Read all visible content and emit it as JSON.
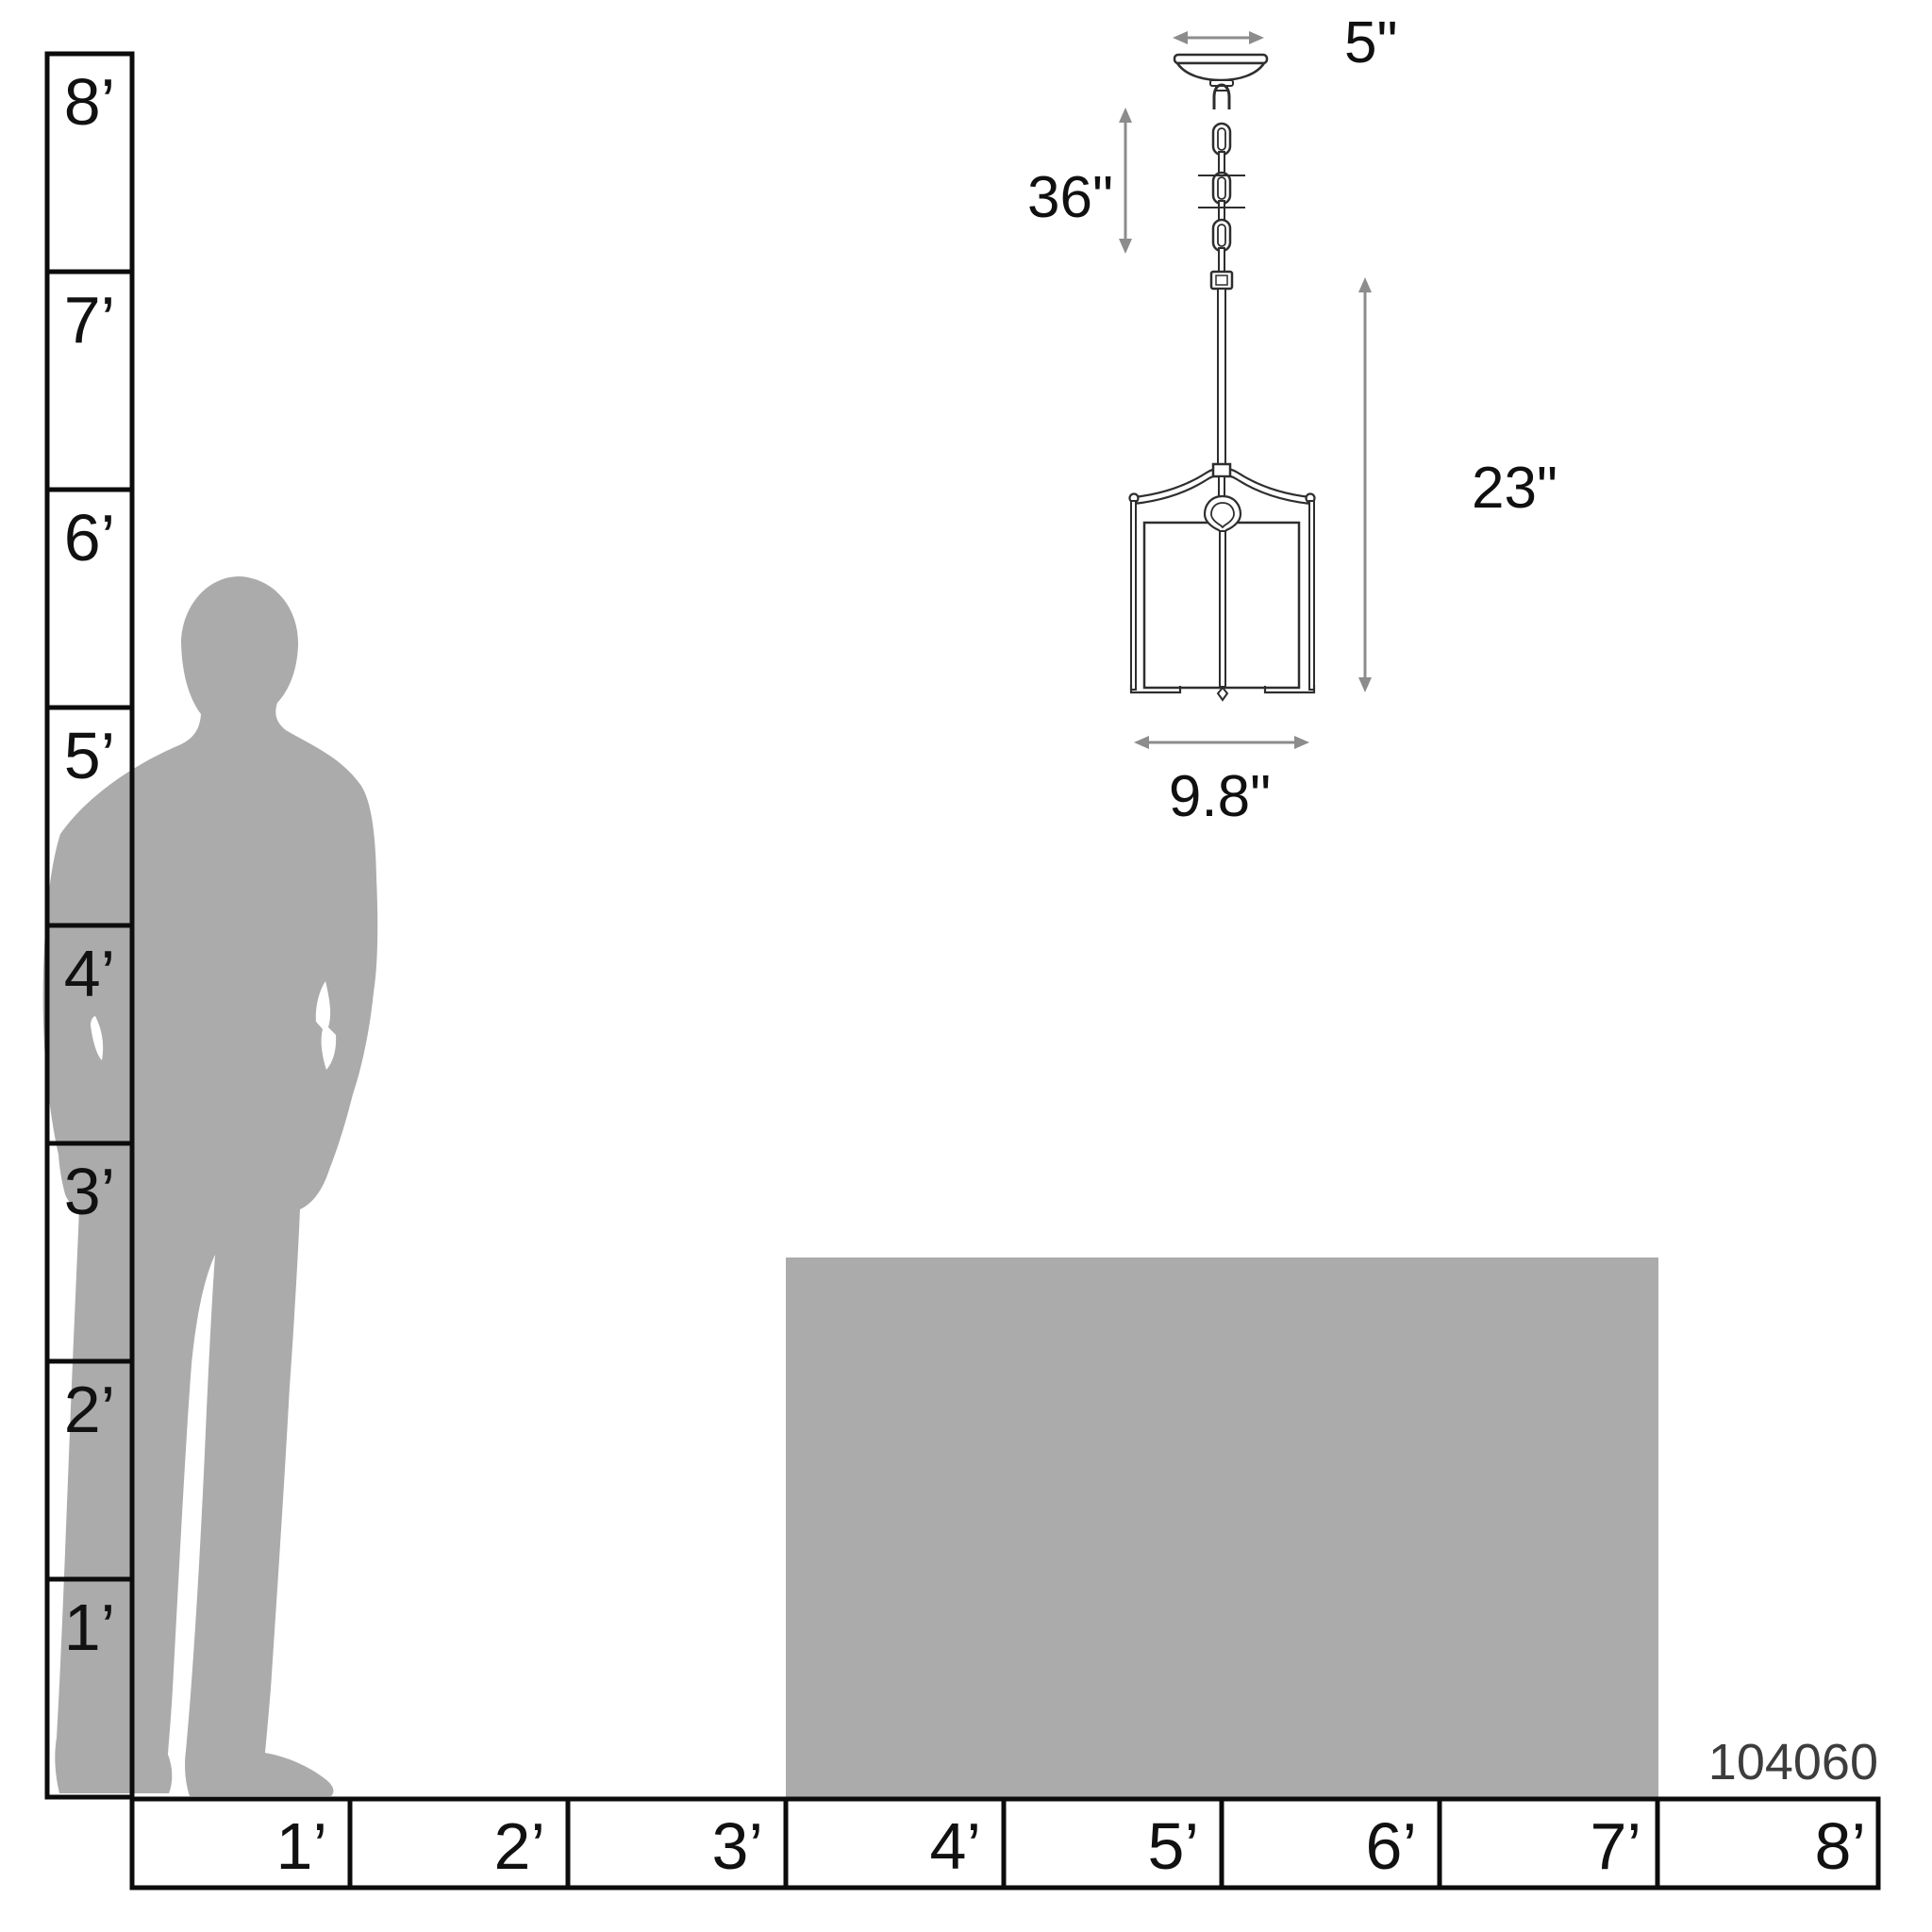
{
  "product_code": "104060",
  "pendant": {
    "canopy_width_label": "5\"",
    "chain_length_label": "36\"",
    "fixture_height_label": "23\"",
    "fixture_width_label": "9.8\""
  },
  "vertical_ruler": {
    "labels": [
      "8’",
      "7’",
      "6’",
      "5’",
      "4’",
      "3’",
      "2’",
      "1’"
    ]
  },
  "horizontal_ruler": {
    "labels": [
      "1’",
      "2’",
      "3’",
      "4’",
      "5’",
      "6’",
      "7’",
      "8’"
    ]
  },
  "colors": {
    "bg": "#ffffff",
    "gray": "#ababab",
    "line": "#0c0c0c",
    "draw": "#2e2e2e",
    "arrow": "#8c8c8c",
    "ink": "#111111",
    "code": "#3d3d3d"
  }
}
